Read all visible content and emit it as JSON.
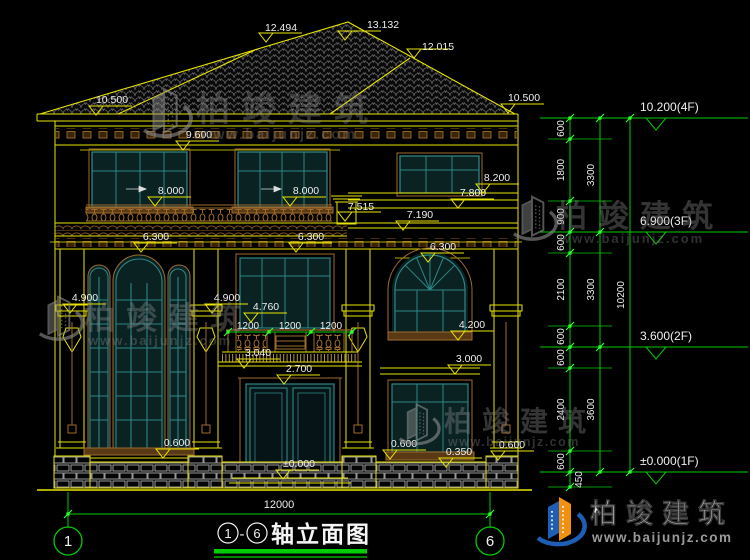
{
  "title": {
    "axis_start": "1",
    "dash": "-",
    "axis_end": "6",
    "name": "轴立面图"
  },
  "axes": {
    "left": "1",
    "right": "6"
  },
  "bottom_dim": "12000",
  "balcony_dims": [
    "1200",
    "1200",
    "1200"
  ],
  "levels": [
    {
      "label": "10.200(4F)"
    },
    {
      "label": "6.900(3F)"
    },
    {
      "label": "3.600(2F)"
    },
    {
      "label": "±0.000(1F)"
    }
  ],
  "chain": {
    "inner": [
      "600",
      "1800",
      "900",
      "600",
      "2100",
      "600",
      "600",
      "2400",
      "600"
    ],
    "middle": [
      "3300",
      "3300",
      "3600"
    ],
    "overall": "10200",
    "below_ground": "450"
  },
  "flags": [
    {
      "id": "roof-peak",
      "label": "13.132"
    },
    {
      "id": "ridge-left",
      "label": "12.494"
    },
    {
      "id": "ridge-right",
      "label": "12.015"
    },
    {
      "id": "eave-left",
      "label": "10.500"
    },
    {
      "id": "eave-right",
      "label": "10.500"
    },
    {
      "id": "soffit",
      "label": "9.600"
    },
    {
      "id": "band-8200",
      "label": "8.200"
    },
    {
      "id": "win3f-left",
      "label": "8.000"
    },
    {
      "id": "win3f-center",
      "label": "8.000"
    },
    {
      "id": "band-7800",
      "label": "7.800"
    },
    {
      "id": "parapet",
      "label": "7.515"
    },
    {
      "id": "band-7190",
      "label": "7.190"
    },
    {
      "id": "cornice-left",
      "label": "6.300"
    },
    {
      "id": "cornice-center",
      "label": "6.300"
    },
    {
      "id": "cornice-right",
      "label": "6.300"
    },
    {
      "id": "capital-left",
      "label": "4.900"
    },
    {
      "id": "capital-center",
      "label": "4.900"
    },
    {
      "id": "balcony-rail",
      "label": "4.760"
    },
    {
      "id": "win2f-right-sill",
      "label": "4.200"
    },
    {
      "id": "balcony-slab",
      "label": "3.040"
    },
    {
      "id": "door-head",
      "label": "2.700"
    },
    {
      "id": "band-3000",
      "label": "3.000"
    },
    {
      "id": "sill-left",
      "label": "0.600"
    },
    {
      "id": "sill-right-a",
      "label": "0.600"
    },
    {
      "id": "plinth-right",
      "label": "0.350"
    },
    {
      "id": "sill-right-b",
      "label": "0.600"
    },
    {
      "id": "ground",
      "label": "±0.000"
    }
  ],
  "watermark": {
    "brand": "柏竣建筑",
    "url": "www.baijunjz.com"
  },
  "logo": {
    "brand": "柏竣建筑",
    "url": "www.baijunjz.com"
  },
  "colors": {
    "background": "#000000",
    "line_yellow": "#e8e400",
    "trim_brown": "#9c6b2e",
    "window_teal": "#2f8585",
    "dim_green": "#00cc00",
    "text_white": "#eeeeee",
    "logo_blue": "#1e5eb5",
    "logo_orange": "#f29111"
  }
}
